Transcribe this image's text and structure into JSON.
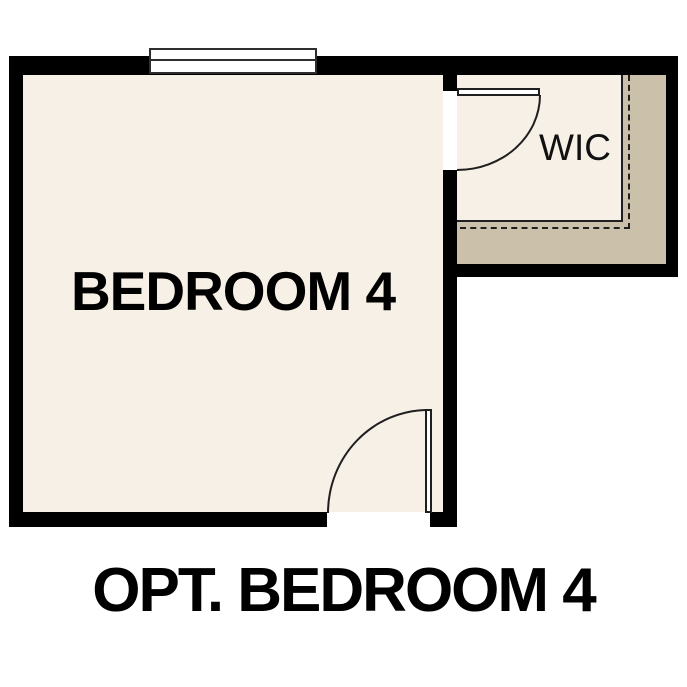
{
  "plan": {
    "type": "floor-plan",
    "labels": {
      "bedroom": "BEDROOM 4",
      "closet": "WIC"
    },
    "caption": "OPT. BEDROOM 4",
    "features": {
      "window": "double-line-window-top-wall",
      "doors": [
        "wic-swing-door",
        "bedroom-entry-swing-door"
      ],
      "closet_shelf": "shelf-edge-solid-with-dashed-rod"
    },
    "colors": {
      "background": "#ffffff",
      "floor": "#f7f0e6",
      "shelf_band": "#cbc1aa",
      "wall": "#000000",
      "line": "#1f1f1f",
      "text": "#000000"
    }
  }
}
